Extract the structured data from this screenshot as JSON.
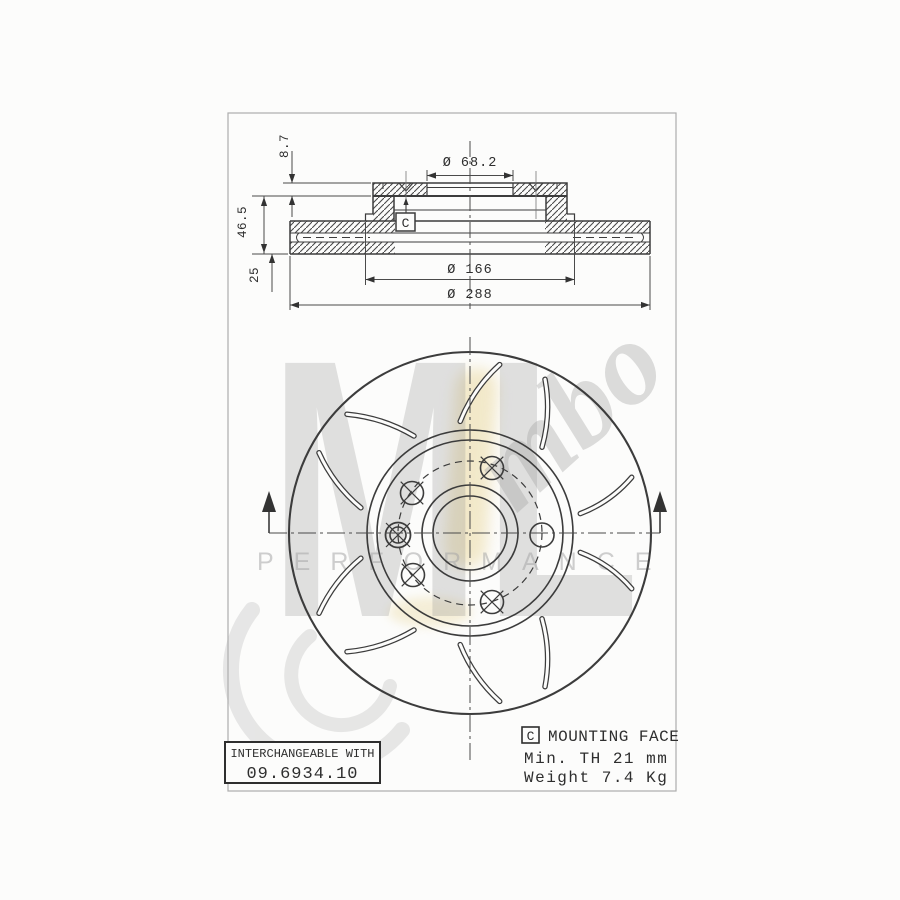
{
  "watermark": {
    "letters": "ML",
    "script": "mbo",
    "performance": "PERFORMANCE"
  },
  "cross_section": {
    "dim_bore": "Ø 68.2",
    "dim_flange": "Ø 166",
    "dim_outer": "Ø 288",
    "dim_plate": "8.7",
    "dim_height": "46.5",
    "dim_thickness": "25",
    "mounting_face_ref": "C"
  },
  "notes": {
    "interchangeable": {
      "line1": "INTERCHANGEABLE WITH",
      "line2": "09.6934.10"
    },
    "specs": {
      "ref": "C",
      "line1": "MOUNTING FACE",
      "line2": "Min. TH 21 mm",
      "line3": "Weight 7.4 Kg"
    }
  },
  "drawing": {
    "center": {
      "x": 470,
      "y": 533
    },
    "circles": [
      {
        "r": 181,
        "w": 2.1
      },
      {
        "r": 103,
        "w": 1.6
      },
      {
        "r": 93,
        "w": 1.6
      },
      {
        "r": 72,
        "w": 1.2,
        "dash": "7 5"
      },
      {
        "r": 48,
        "w": 1.6
      },
      {
        "r": 37,
        "w": 1.6
      }
    ],
    "slot_inner_radius": 112,
    "slot_outer_radius": 171,
    "slots": [
      [
        -95,
        -80,
        -1
      ],
      [
        95,
        80,
        1
      ],
      [
        -120,
        -136,
        1
      ],
      [
        120,
        136,
        -1
      ],
      [
        -50,
        -64,
        1
      ],
      [
        50,
        64,
        -1
      ],
      [
        -10,
        -19,
        1
      ],
      [
        10,
        19,
        -1
      ],
      [
        -167,
        -152,
        -1
      ],
      [
        167,
        152,
        1
      ]
    ],
    "holes": [
      {
        "x": 492,
        "y": 468,
        "type": "cross"
      },
      {
        "x": 412,
        "y": 493,
        "type": "cross"
      },
      {
        "x": 398,
        "y": 535,
        "type": "double"
      },
      {
        "x": 413,
        "y": 575,
        "type": "cross"
      },
      {
        "x": 492,
        "y": 602,
        "type": "cross"
      },
      {
        "x": 542,
        "y": 535,
        "type": "plain"
      }
    ]
  }
}
